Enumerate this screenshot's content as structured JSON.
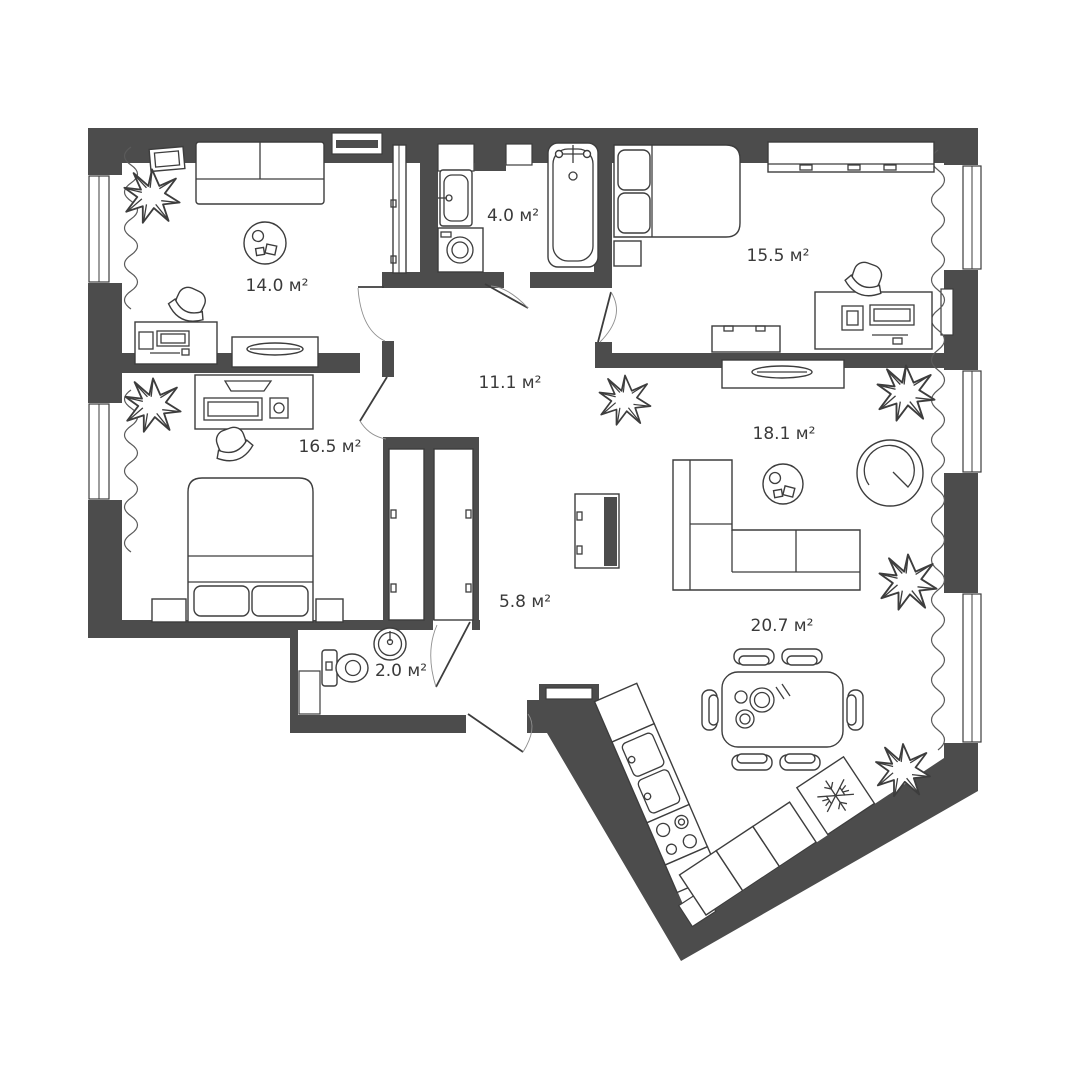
{
  "meta": {
    "title": "Apartment floor plan",
    "unit": "м²"
  },
  "colors": {
    "wall": "#4c4c4c",
    "line": "#3d3d3d",
    "text": "#3a3a3a",
    "bg": "#ffffff"
  },
  "rooms": [
    {
      "id": "room-14",
      "label": "14.0 м²"
    },
    {
      "id": "bathroom",
      "label": "4.0 м²"
    },
    {
      "id": "bedroom-15",
      "label": "15.5 м²"
    },
    {
      "id": "hallway",
      "label": "11.1 м²"
    },
    {
      "id": "bedroom-16",
      "label": "16.5 м²"
    },
    {
      "id": "living",
      "label": "18.1 м²"
    },
    {
      "id": "corridor",
      "label": "5.8 м²"
    },
    {
      "id": "wc",
      "label": "2.0 м²"
    },
    {
      "id": "kitchen-dining",
      "label": "20.7 м²"
    }
  ]
}
